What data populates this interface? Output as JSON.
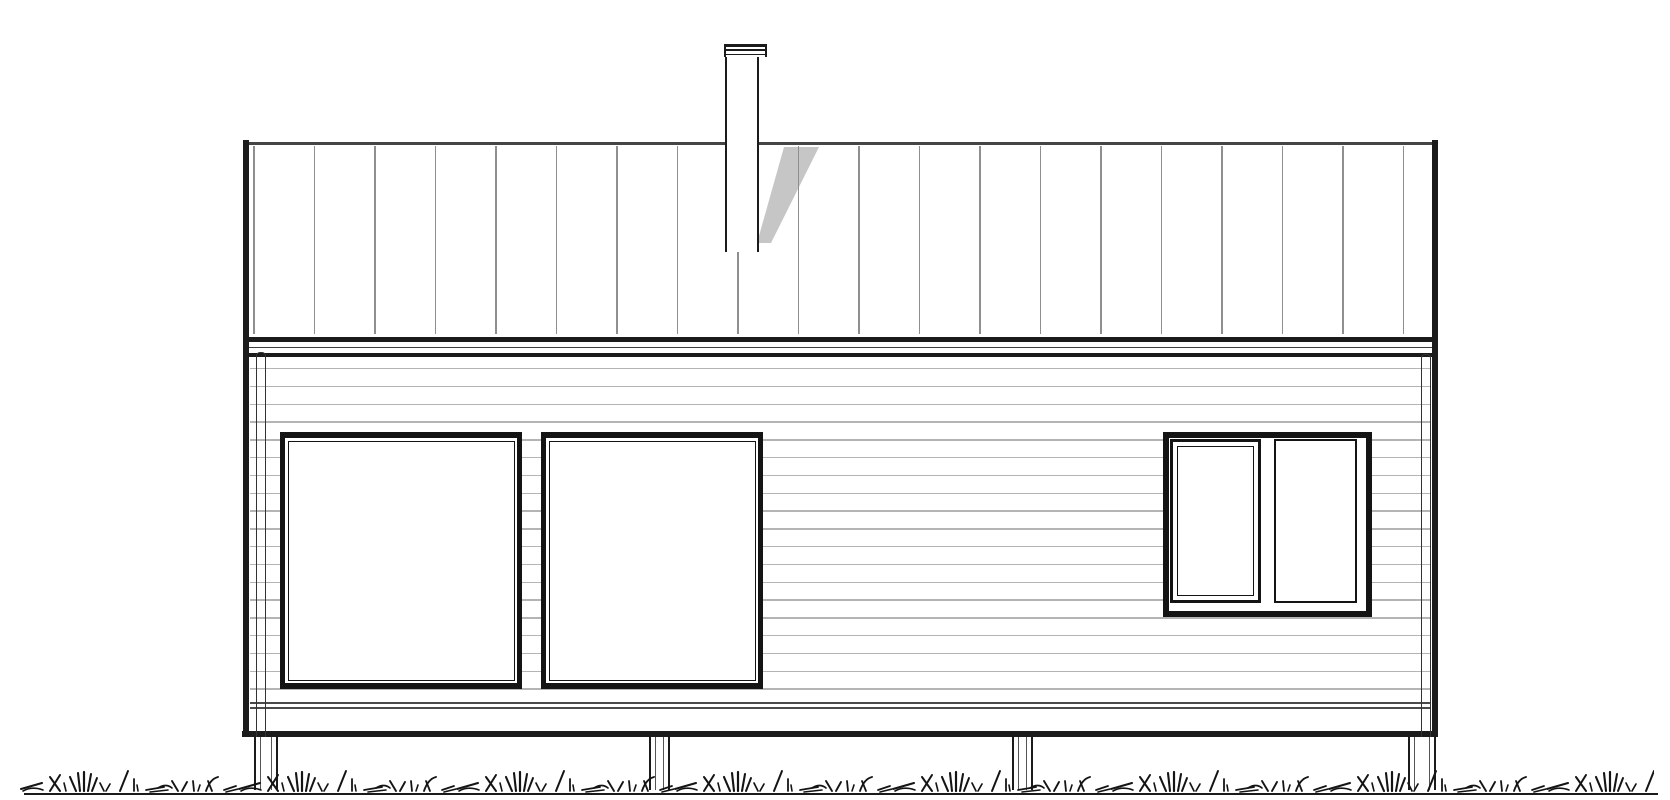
{
  "meta": {
    "drawing_type": "architectural-elevation",
    "subject": "single-story house rear elevation: standing-seam roof band with chimney and cast shadow, horizontal lap siding, two large fixed windows, one double-pane window unit, two corner downspouts, pier foundation posts, grass ground line",
    "visible_text": "none"
  },
  "canvas": {
    "width": 1670,
    "height": 800,
    "background": "#ffffff"
  },
  "palette": {
    "heavy": "#1b1b1b",
    "frame": "#141414",
    "roof_edge": "#454545",
    "thin_dark": "#3f3f3f",
    "seam": "#8f8f8f",
    "siding": "#b4b4b4",
    "watertable": "#4a4a4a",
    "shadow": "#c6c6c6",
    "pipe": "#333333",
    "post_inner": "#555555"
  },
  "roof": {
    "x": 243,
    "width": 1195,
    "top_bar": {
      "y": 142,
      "h": 3.2
    },
    "panel": {
      "y": 145,
      "h": 192
    },
    "seams": {
      "count": 20,
      "first_x": 253,
      "spacing": 60.5,
      "y1": 146,
      "y2": 334,
      "w": 1.6
    },
    "bottom_bar": {
      "y": 337,
      "h": 5
    },
    "trim_line": {
      "y": 346.5,
      "h": 1.6
    },
    "fascia_bar": {
      "y": 352.5,
      "h": 4.5
    }
  },
  "chimney": {
    "flue": {
      "x": 725,
      "y": 57,
      "w": 34,
      "h": 195,
      "line": 2.2
    },
    "cap": {
      "x": 724,
      "y": 43.5,
      "w": 43,
      "h": 13.5,
      "top": 3.2,
      "side": 2,
      "bands": [
        6,
        10.5
      ],
      "band_h": 1.5
    },
    "shadow_polygon": [
      [
        784,
        147
      ],
      [
        819,
        147
      ],
      [
        771,
        243
      ],
      [
        757,
        243
      ]
    ]
  },
  "wall": {
    "x": 250,
    "y": 357,
    "width": 1181,
    "height": 374,
    "siding": {
      "first_y": 368,
      "spacing": 17.8,
      "count": 19,
      "h": 1.4
    },
    "watertable_y": [
      702,
      707
    ],
    "watertable_h": 1.5,
    "bottom_bar": {
      "x": 242,
      "y": 731,
      "w": 1196,
      "h": 5.5
    },
    "corners": {
      "y": 140,
      "h": 591,
      "w": 6,
      "left_x": 242.5,
      "right_x": 1431.5
    }
  },
  "windows": {
    "large": [
      {
        "x": 280,
        "y": 432,
        "w": 242,
        "h": 257
      },
      {
        "x": 541,
        "y": 432,
        "w": 222,
        "h": 257
      }
    ],
    "large_border": {
      "top": 6.5,
      "side": 5.5,
      "bottom": 6,
      "inner_inset": 2.5,
      "inner_line": 1.7
    },
    "unit": {
      "x": 1163,
      "y": 432,
      "w": 209,
      "h": 185,
      "border": {
        "top": 6.5,
        "side": 6,
        "bottom": 6
      },
      "pane_left": {
        "left": 1,
        "top": 1,
        "w": 91,
        "h": 164,
        "border": 3,
        "inner_inset": 4,
        "inner_line": 1.6
      },
      "pane_right": {
        "left": 105,
        "top": 1,
        "w": 83,
        "h": 164,
        "border": 2.4
      }
    }
  },
  "downspouts": [
    {
      "x": 256,
      "y": 352,
      "w": 9.5,
      "h": 438,
      "line": 1.7
    },
    {
      "x": 1421,
      "y": 354,
      "w": 10,
      "h": 434,
      "line": 1.7
    }
  ],
  "posts": {
    "y": 737,
    "h": 53,
    "edge": 2.2,
    "inner_inset": 4,
    "inner_w": 1.2,
    "items": [
      {
        "x": 254,
        "w": 24
      },
      {
        "x": 649,
        "w": 21
      },
      {
        "x": 1012,
        "w": 21
      },
      {
        "x": 1408,
        "w": 28
      }
    ]
  },
  "ground": {
    "x": 24,
    "y": 792.5,
    "w": 1634,
    "h": 2.6
  },
  "grass": {
    "x": 20,
    "y": 763,
    "w": 1634,
    "h": 31,
    "tile_w": 218,
    "tile_h": 31,
    "strokes": [
      {
        "d": "M1,26 L22,20",
        "w": 2.0
      },
      {
        "d": "M3,28 Q12,23 23,27",
        "w": 1.6
      },
      {
        "d": "M30,28 L40,12",
        "w": 2.0
      },
      {
        "d": "M40,28 L30,14",
        "w": 2.0
      },
      {
        "d": "M46,28 L44,20",
        "w": 1.6
      },
      {
        "d": "M56,28 L50,14",
        "w": 2.1
      },
      {
        "d": "M60,28 L58,10",
        "w": 2.1
      },
      {
        "d": "M64,28 L64,9",
        "w": 2.2
      },
      {
        "d": "M68,28 L71,11",
        "w": 2.1
      },
      {
        "d": "M72,28 L77,15",
        "w": 2.0
      },
      {
        "d": "M84,28 L80,20",
        "w": 1.7
      },
      {
        "d": "M86,28 L90,21",
        "w": 1.7
      },
      {
        "d": "M100,28 L108,8",
        "w": 2.0
      },
      {
        "d": "M114,28 L114,16",
        "w": 1.8
      },
      {
        "d": "M118,28 L117,22",
        "w": 1.6
      },
      {
        "d": "M126,27 L144,24",
        "w": 1.8
      },
      {
        "d": "M130,29 L148,27",
        "w": 1.6
      },
      {
        "d": "M138,25 Q146,20 152,25",
        "w": 1.7
      },
      {
        "d": "M158,28 L152,18",
        "w": 1.9
      },
      {
        "d": "M162,28 L167,19",
        "w": 1.9
      },
      {
        "d": "M174,28 L173,18",
        "w": 1.8
      },
      {
        "d": "M178,28 L180,22",
        "w": 1.6
      },
      {
        "d": "M186,28 Q190,16 198,14",
        "w": 1.9
      },
      {
        "d": "M192,28 L188,18",
        "w": 1.8
      },
      {
        "d": "M204,27 L216,23",
        "w": 1.8
      },
      {
        "d": "M206,29 L218,26",
        "w": 1.6
      }
    ]
  }
}
